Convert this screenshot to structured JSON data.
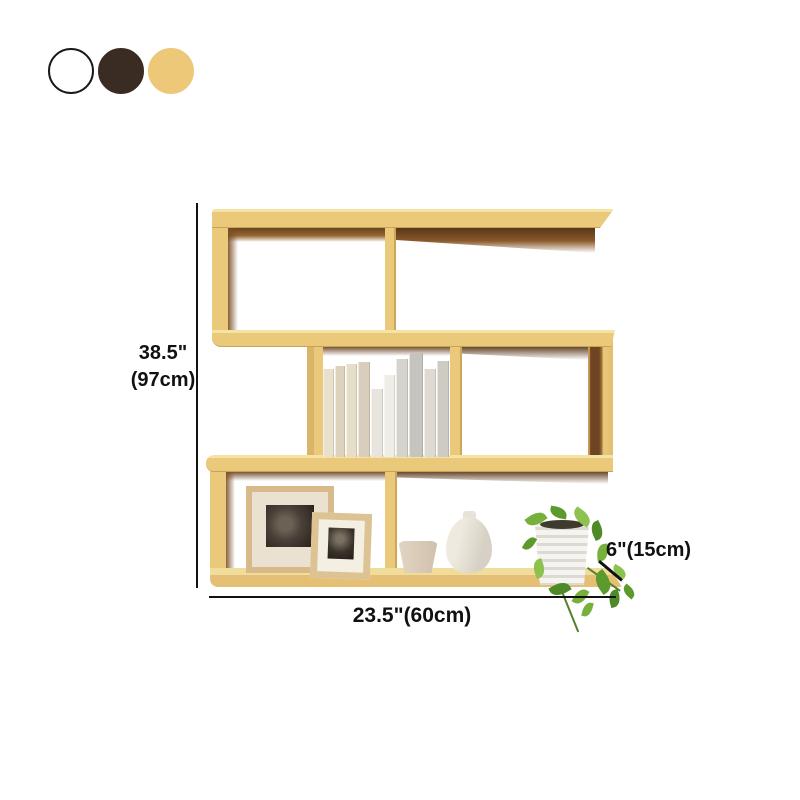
{
  "page": {
    "background": "#ffffff"
  },
  "swatches": {
    "items": [
      {
        "name": "white",
        "color": "#ffffff",
        "border": "#1a1a1a"
      },
      {
        "name": "dark-brown",
        "color": "#3a2b23",
        "border": "#3a2b23"
      },
      {
        "name": "light-wood",
        "color": "#edc878",
        "border": "#edc878"
      }
    ]
  },
  "dimensions": {
    "height_inches": "38.5\"",
    "height_cm": "(97cm)",
    "width": "23.5\"(60cm)",
    "depth": "6\"(15cm)"
  },
  "shelf": {
    "description": "light-wood zigzag 3-tier wall shelf with books, picture frames, vases and potted plant",
    "wood_color": "#eac97b",
    "wood_top_highlight": "#f5e3a6",
    "wood_shadow_dark": "#5e3b1e",
    "books": [
      {
        "w": 11,
        "h": 88,
        "c": "#e9e1cd"
      },
      {
        "w": 10,
        "h": 91,
        "c": "#ddd3bd"
      },
      {
        "w": 11,
        "h": 93,
        "c": "#e7deca"
      },
      {
        "w": 12,
        "h": 95,
        "c": "#d8cebb"
      },
      {
        "w": 12,
        "h": 68,
        "c": "#e8e5de"
      },
      {
        "w": 11,
        "h": 82,
        "c": "#f0ede7"
      },
      {
        "w": 12,
        "h": 98,
        "c": "#d5d3cc"
      },
      {
        "w": 14,
        "h": 104,
        "c": "#c6c4be"
      },
      {
        "w": 12,
        "h": 88,
        "c": "#dedad2"
      },
      {
        "w": 12,
        "h": 96,
        "c": "#cecbc3"
      }
    ],
    "leaf_colors": [
      "#76b13c",
      "#5d9a2e",
      "#8cc24d",
      "#4e8a28"
    ],
    "leaves": [
      {
        "x": 6,
        "y": 8,
        "s": 20,
        "r": -35
      },
      {
        "x": 30,
        "y": 2,
        "s": 17,
        "r": 10
      },
      {
        "x": 52,
        "y": 6,
        "s": 20,
        "r": 35
      },
      {
        "x": 68,
        "y": 20,
        "s": 18,
        "r": 65
      },
      {
        "x": 74,
        "y": 42,
        "s": 17,
        "r": 85
      },
      {
        "x": 2,
        "y": 34,
        "s": 15,
        "r": -60
      },
      {
        "x": 10,
        "y": 58,
        "s": 18,
        "r": -110
      },
      {
        "x": 30,
        "y": 78,
        "s": 20,
        "r": 150
      },
      {
        "x": 52,
        "y": 86,
        "s": 17,
        "r": 120
      },
      {
        "x": 72,
        "y": 70,
        "s": 22,
        "r": 55
      },
      {
        "x": 92,
        "y": 62,
        "s": 15,
        "r": 30
      },
      {
        "x": 86,
        "y": 88,
        "s": 17,
        "r": 75
      },
      {
        "x": 60,
        "y": 100,
        "s": 15,
        "r": 105
      },
      {
        "x": 102,
        "y": 82,
        "s": 14,
        "r": 40
      }
    ]
  }
}
